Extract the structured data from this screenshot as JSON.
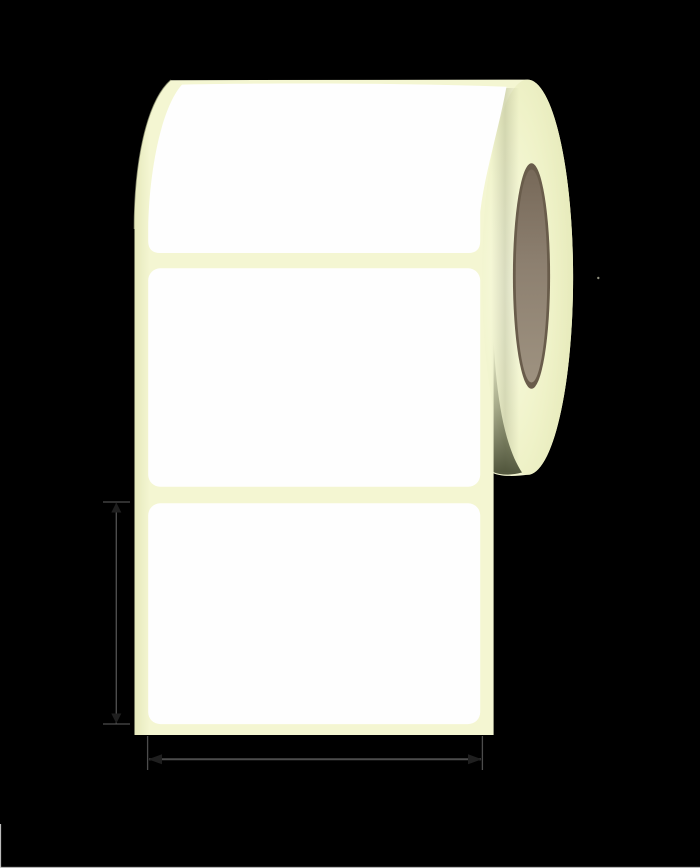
{
  "illustration": {
    "kind": "label-roll-product-diagram",
    "labels_on_liner": 3,
    "dimension_markers": [
      "label-height-marker",
      "label-width-marker"
    ]
  },
  "colors": {
    "background": "#000000",
    "liner_cream": "#f4f6d2",
    "liner_cream_edge": "#e6e9bc",
    "face_light": "#f9fbe0",
    "face_mid": "#eff2c8",
    "face_dark": "#e2e6b4",
    "label_white": "#fefefe",
    "shadow_olive": "#3c4129",
    "seam_shadow": "#6b7050",
    "core_rim": "#695c4b",
    "core_dark": "#776959",
    "core_mid": "#8d8070",
    "core_light": "#9e9280",
    "arrow_line": "#4c4c4c",
    "arrow_head": "#1f1f1f",
    "edge_artifact": "#cfcfcf",
    "dot_artifact": "#90907e"
  }
}
